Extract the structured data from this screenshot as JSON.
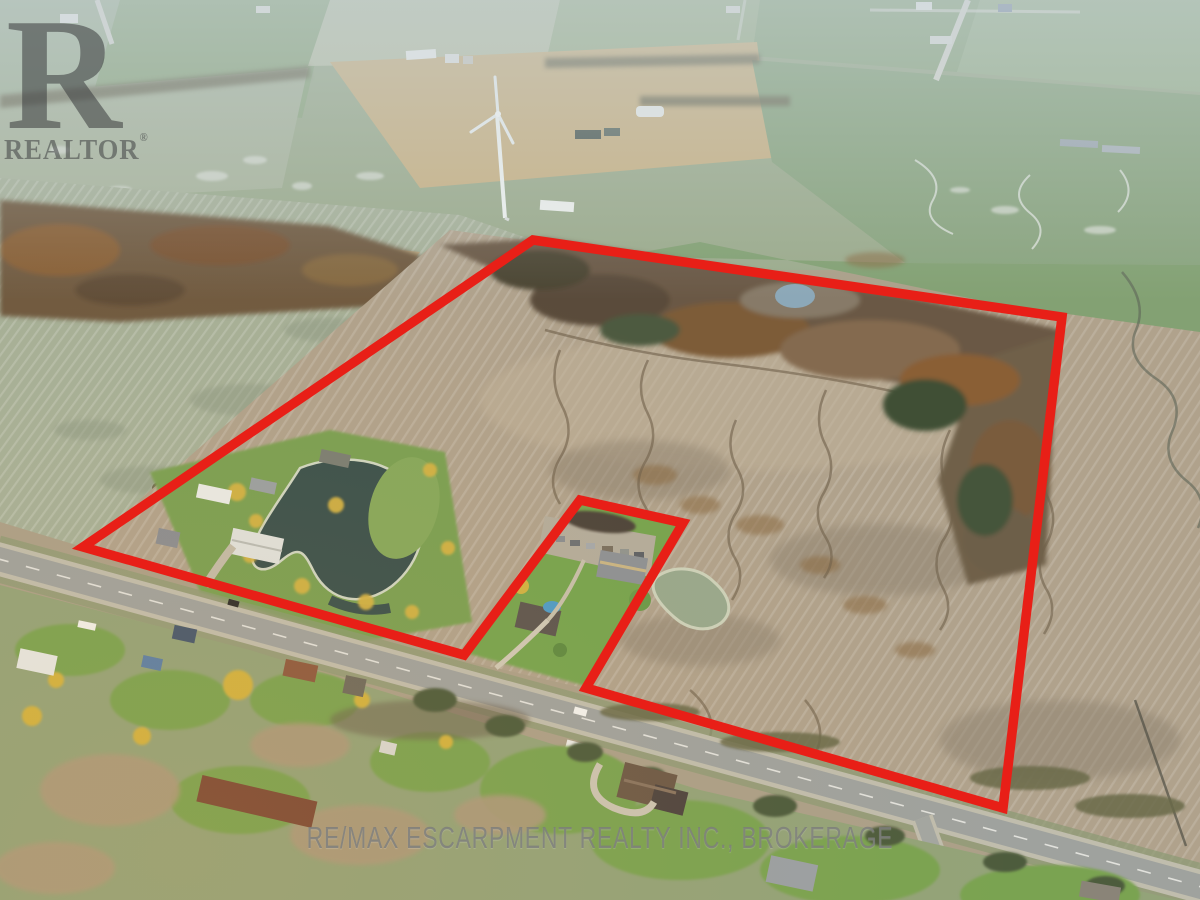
{
  "watermarks": {
    "realtor_logo_letter": "R",
    "realtor_logo_text": "REALTOR",
    "registered_mark": "®",
    "brokerage_text": "RE/MAX ESCARPMENT REALTY INC., BROKERAGE"
  },
  "colors": {
    "boundary_red": "#e81f17",
    "field_tan": "#b0a28c",
    "field_sage": "#a6b098",
    "lawn_green": "#77a450",
    "road_gray": "#9fa29e",
    "forest_brown": "#6b5944",
    "pond_dark": "#3a514d",
    "pond_pale": "#98a88d"
  }
}
